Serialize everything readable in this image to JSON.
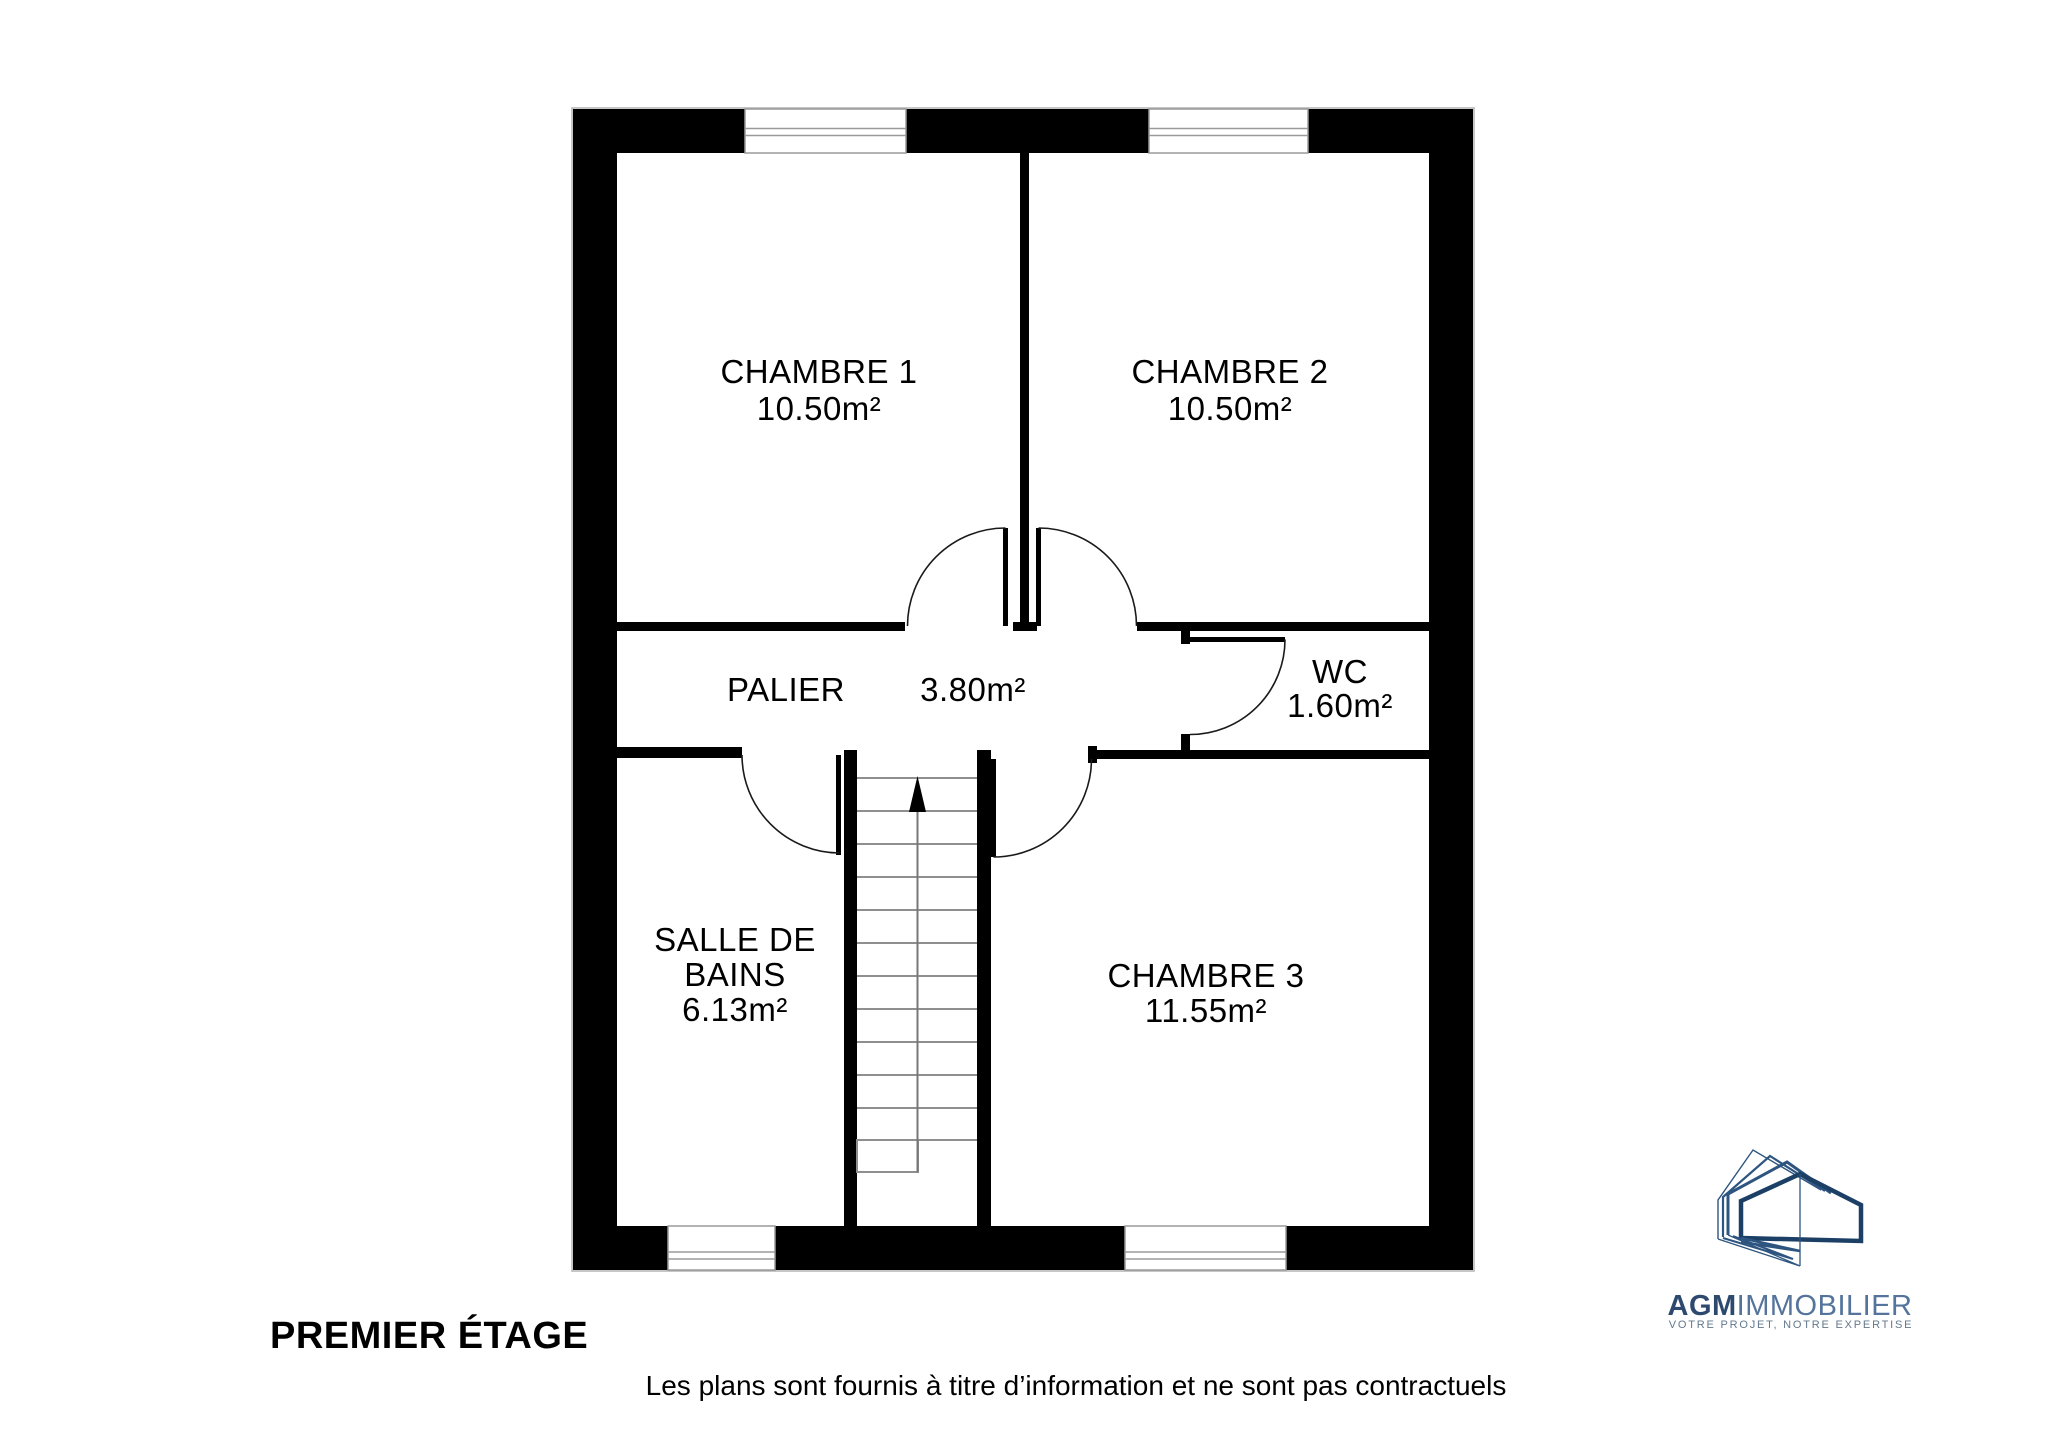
{
  "plan": {
    "title": "PREMIER ÉTAGE",
    "disclaimer": "Les plans sont fournis à titre d’information et ne sont pas contractuels",
    "rooms": [
      {
        "name": "chambre-1",
        "label": "CHAMBRE 1",
        "area": "10.50m²"
      },
      {
        "name": "chambre-2",
        "label": "CHAMBRE 2",
        "area": "10.50m²"
      },
      {
        "name": "palier",
        "label": "PALIER",
        "area": "3.80m²"
      },
      {
        "name": "wc",
        "label": "WC",
        "area": "1.60m²"
      },
      {
        "name": "salle-de-bains",
        "label_line1": "SALLE DE",
        "label_line2": "BAINS",
        "area": "6.13m²"
      },
      {
        "name": "chambre-3",
        "label": "CHAMBRE 3",
        "area": "11.55m²"
      }
    ],
    "stairs_direction": "up"
  },
  "logo": {
    "brand_bold": "AGM",
    "brand_light": "IMMOBILIER",
    "tagline": "VOTRE PROJET, NOTRE EXPERTISE"
  },
  "colors": {
    "wall": "#000000",
    "window_frame": "#9a9a9a",
    "stair_lines": "#8f8f8f",
    "door_arc": "#1a1a1a",
    "logo_navy_dark": "#1c3f66",
    "logo_navy_mid": "#2e5580",
    "logo_text_brand": "#2d4a6e",
    "logo_text_light": "#55749c",
    "logo_tagline": "#63788c",
    "text": "#000000"
  }
}
